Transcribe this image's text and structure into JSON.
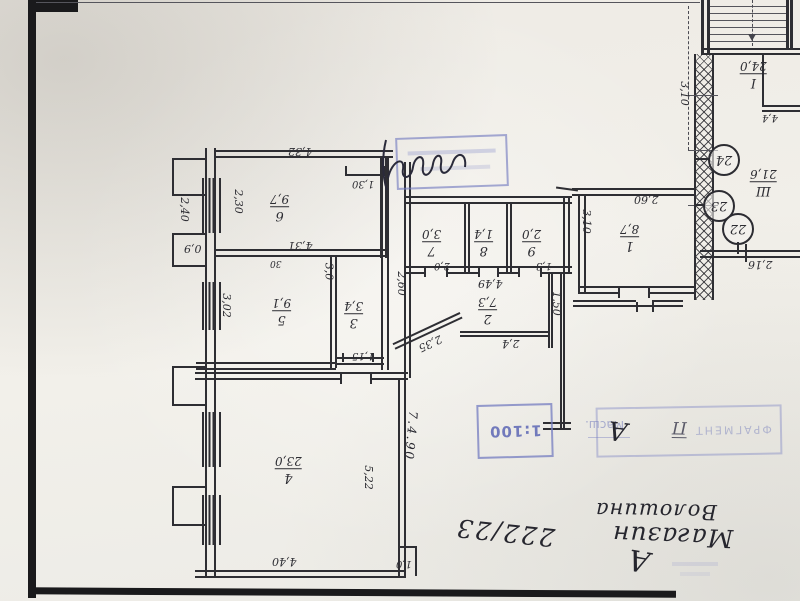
{
  "plan": {
    "rooms": {
      "r1": {
        "num": "1",
        "area": "8,7"
      },
      "r2": {
        "num": "2",
        "area": "7,3"
      },
      "r3": {
        "num": "3",
        "area": "3,4"
      },
      "r4": {
        "num": "4",
        "area": "23,0"
      },
      "r5": {
        "num": "5",
        "area": "9,1"
      },
      "r6": {
        "num": "6",
        "area": "9,7"
      },
      "r7": {
        "num": "7",
        "area": "3,0"
      },
      "r8": {
        "num": "8",
        "area": "1,4"
      },
      "r9": {
        "num": "9",
        "area": "2,0"
      },
      "stair_hall": {
        "num": "I",
        "area": "24,0"
      },
      "entry_hall": {
        "num": "Ш",
        "area": "21,6"
      }
    },
    "circles": {
      "c24": "24",
      "c23": "23",
      "c22": "22"
    },
    "dims": {
      "top6": "4,32",
      "door6": "1,30",
      "left6v": "2,30",
      "mid6": "4,31",
      "wall6": "30",
      "outer_left_v": "2,40",
      "outer_left_small": "0,9",
      "left5v": "3,02",
      "right3v": "3,0",
      "door3": "1,15",
      "corridor_v": "2,60",
      "room2w": "4,49",
      "door7": "2,0",
      "door9": "1,3",
      "door2": "2,4",
      "diag": "2,35",
      "exit_v": "1,50",
      "room4w": "4,40",
      "room4h": "5,22",
      "notch": "1,0",
      "room1w": "2,60",
      "room1h": "3,10",
      "stair_v": "3,10",
      "stair_small": "4,4",
      "hall_w": "2,16"
    },
    "date": "7.4.90"
  },
  "stamps": {
    "scale_label": "Масш.",
    "scale_value": "1:100",
    "fragment_text": "ФРАГМЕНТ",
    "fragment_letter": "А",
    "fragment_mark": "П"
  },
  "handwriting": {
    "line1": "Магазин",
    "line2": "Волошина",
    "number": "222/23",
    "letter": "А"
  }
}
